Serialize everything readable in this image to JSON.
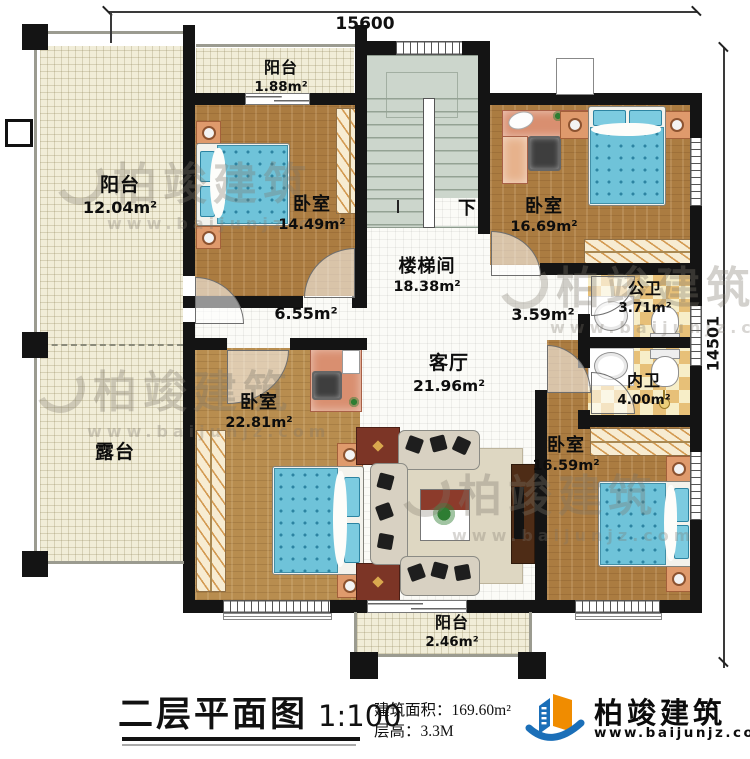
{
  "dimensions": {
    "top": "15600",
    "right": "14501"
  },
  "rooms": {
    "balcony_left": {
      "name": "阳台",
      "area": "12.04m²"
    },
    "terrace": {
      "name": "露台"
    },
    "balcony_top": {
      "name": "阳台",
      "area": "1.88m²"
    },
    "bedroom_nw": {
      "name": "卧室",
      "area": "14.49m²"
    },
    "stairwell": {
      "name": "楼梯间",
      "area": "18.38m²",
      "down": "下"
    },
    "bedroom_ne": {
      "name": "卧室",
      "area": "16.69m²"
    },
    "hall_west": {
      "area": "6.55m²"
    },
    "hall_east": {
      "area": "3.59m²"
    },
    "living": {
      "name": "客厅",
      "area": "21.96m²"
    },
    "bath_public": {
      "name": "公卫",
      "area": "3.71m²"
    },
    "bath_private": {
      "name": "内卫",
      "area": "4.00m²"
    },
    "bedroom_sw": {
      "name": "卧室",
      "area": "22.81m²"
    },
    "bedroom_se": {
      "name": "卧室",
      "area": "16.59m²"
    },
    "balcony_bottom": {
      "name": "阳台",
      "area": "2.46m²"
    }
  },
  "titleblock": {
    "title": "二层平面图",
    "scale": "1:100",
    "area_label": "建筑面积：",
    "area_value": "169.60m²",
    "floor_height_label": "层高：",
    "floor_height_value": "3.3M"
  },
  "logo": {
    "brand": "柏竣建筑",
    "url": "www.baijunjz.com"
  },
  "watermark": {
    "brand": "柏竣建筑",
    "url": "www.baijunjz.com"
  },
  "colors": {
    "wall": "#141414",
    "wood": "#ab7c41",
    "tile_dark": "#e7c078",
    "bedding": "#6fc3d9",
    "logo_blue": "#1b6fb8",
    "logo_orange": "#f08c00"
  }
}
